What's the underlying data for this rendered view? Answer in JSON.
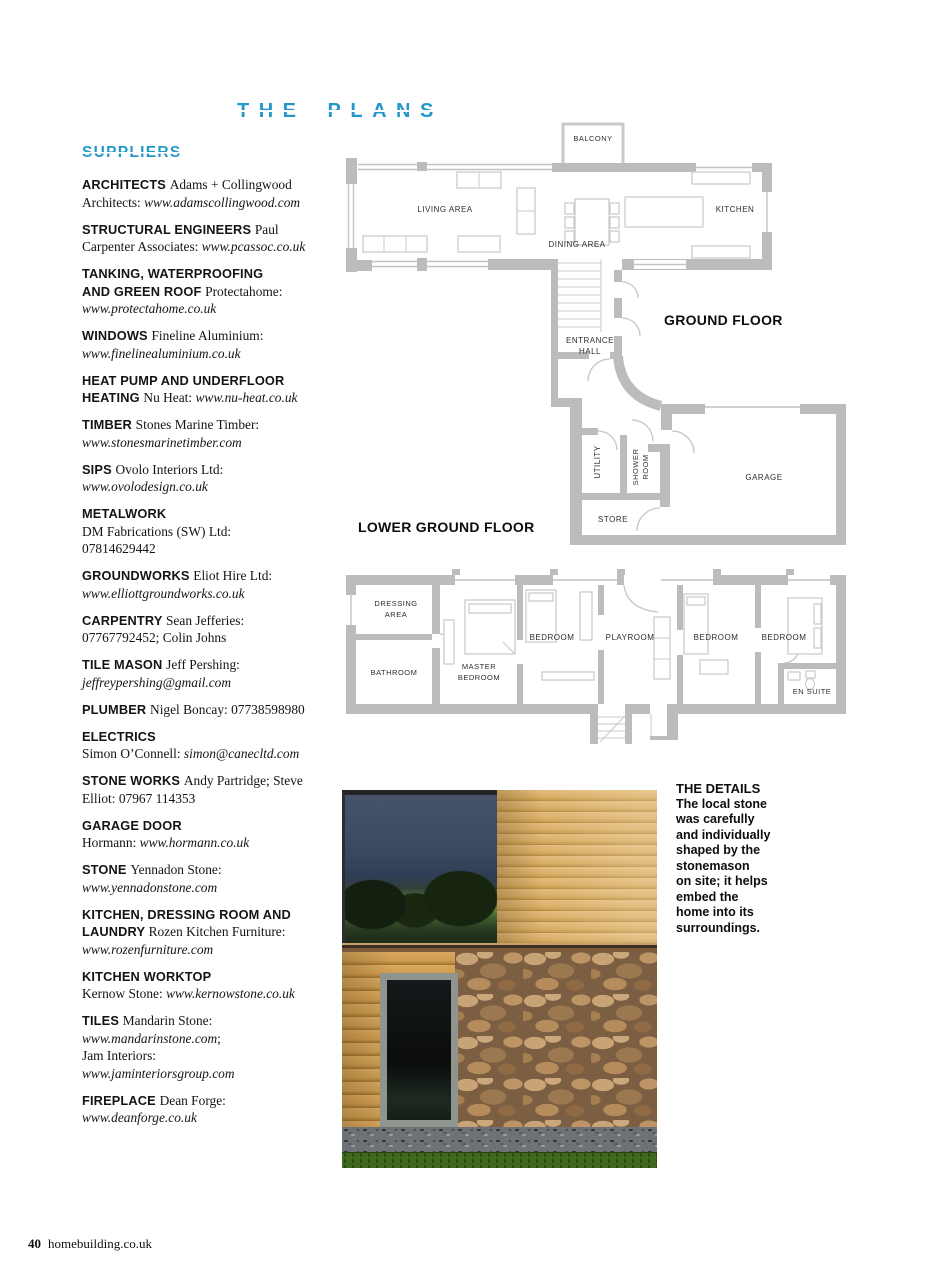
{
  "page": {
    "title": "THE PLANS",
    "footer": {
      "page_number": "40",
      "site": "homebuilding.co.uk"
    }
  },
  "colors": {
    "accent_blue": "#2496c8",
    "plan_wall_gray": "#bcbcbc",
    "plan_label": "#2e2e2e"
  },
  "suppliers": {
    "heading": "SUPPLIERS",
    "entries": [
      {
        "segments": [
          {
            "style": "b",
            "text": "ARCHITECTS "
          },
          {
            "style": "r",
            "text": "Adams + Collingwood Architects: "
          },
          {
            "style": "i",
            "text": "www.adamscollingwood.com"
          }
        ]
      },
      {
        "segments": [
          {
            "style": "b",
            "text": "STRUCTURAL ENGINEERS "
          },
          {
            "style": "r",
            "text": "Paul Carpenter Associates: "
          },
          {
            "style": "i",
            "text": "www.pcassoc.co.uk"
          }
        ]
      },
      {
        "segments": [
          {
            "style": "b",
            "text": "TANKING, WATERPROOFING"
          },
          {
            "style": "br",
            "text": ""
          },
          {
            "style": "b",
            "text": "AND GREEN ROOF "
          },
          {
            "style": "r",
            "text": "Protectahome:"
          },
          {
            "style": "br",
            "text": ""
          },
          {
            "style": "i",
            "text": "www.protectahome.co.uk"
          }
        ]
      },
      {
        "segments": [
          {
            "style": "b",
            "text": "WINDOWS "
          },
          {
            "style": "r",
            "text": "Fineline Aluminium:"
          },
          {
            "style": "br",
            "text": ""
          },
          {
            "style": "i",
            "text": "www.finelinealuminium.co.uk"
          }
        ]
      },
      {
        "segments": [
          {
            "style": "b",
            "text": "HEAT PUMP AND UNDERFLOOR"
          },
          {
            "style": "br",
            "text": ""
          },
          {
            "style": "b",
            "text": "HEATING "
          },
          {
            "style": "r",
            "text": "Nu Heat: "
          },
          {
            "style": "i",
            "text": "www.nu-heat.co.uk"
          }
        ]
      },
      {
        "segments": [
          {
            "style": "b",
            "text": "TIMBER "
          },
          {
            "style": "r",
            "text": "Stones Marine Timber:"
          },
          {
            "style": "br",
            "text": ""
          },
          {
            "style": "i",
            "text": "www.stonesmarinetimber.com"
          }
        ]
      },
      {
        "segments": [
          {
            "style": "b",
            "text": "SIPS "
          },
          {
            "style": "r",
            "text": "Ovolo Interiors Ltd:"
          },
          {
            "style": "br",
            "text": ""
          },
          {
            "style": "i",
            "text": "www.ovolodesign.co.uk"
          }
        ]
      },
      {
        "segments": [
          {
            "style": "b",
            "text": "METALWORK"
          },
          {
            "style": "br",
            "text": ""
          },
          {
            "style": "r",
            "text": "DM Fabrications (SW) Ltd:"
          },
          {
            "style": "br",
            "text": ""
          },
          {
            "style": "r",
            "text": "07814629442"
          }
        ]
      },
      {
        "segments": [
          {
            "style": "b",
            "text": "GROUNDWORKS "
          },
          {
            "style": "r",
            "text": "Eliot Hire Ltd:"
          },
          {
            "style": "br",
            "text": ""
          },
          {
            "style": "i",
            "text": "www.elliottgroundworks.co.uk"
          }
        ]
      },
      {
        "segments": [
          {
            "style": "b",
            "text": "CARPENTRY "
          },
          {
            "style": "r",
            "text": "Sean Jefferies:"
          },
          {
            "style": "br",
            "text": ""
          },
          {
            "style": "r",
            "text": "07767792452; Colin Johns"
          }
        ]
      },
      {
        "segments": [
          {
            "style": "b",
            "text": "TILE MASON "
          },
          {
            "style": "r",
            "text": "Jeff Pershing:"
          },
          {
            "style": "br",
            "text": ""
          },
          {
            "style": "i",
            "text": "jeffreypershing@gmail.com"
          }
        ]
      },
      {
        "segments": [
          {
            "style": "b",
            "text": "PLUMBER "
          },
          {
            "style": "r",
            "text": "Nigel Boncay: 07738598980"
          }
        ]
      },
      {
        "segments": [
          {
            "style": "b",
            "text": "ELECTRICS"
          },
          {
            "style": "br",
            "text": ""
          },
          {
            "style": "r",
            "text": "Simon O’Connell: "
          },
          {
            "style": "i",
            "text": "simon@canecltd.com"
          }
        ]
      },
      {
        "segments": [
          {
            "style": "b",
            "text": "STONE WORKS "
          },
          {
            "style": "r",
            "text": "Andy Partridge; Steve"
          },
          {
            "style": "br",
            "text": ""
          },
          {
            "style": "r",
            "text": "Elliot: 07967 114353"
          }
        ]
      },
      {
        "segments": [
          {
            "style": "b",
            "text": "GARAGE DOOR"
          },
          {
            "style": "br",
            "text": ""
          },
          {
            "style": "r",
            "text": "Hormann: "
          },
          {
            "style": "i",
            "text": "www.hormann.co.uk"
          }
        ]
      },
      {
        "segments": [
          {
            "style": "b",
            "text": "STONE "
          },
          {
            "style": "r",
            "text": "Yennadon Stone:"
          },
          {
            "style": "br",
            "text": ""
          },
          {
            "style": "i",
            "text": "www.yennadonstone.com"
          }
        ]
      },
      {
        "segments": [
          {
            "style": "b",
            "text": "KITCHEN, DRESSING ROOM AND"
          },
          {
            "style": "br",
            "text": ""
          },
          {
            "style": "b",
            "text": "LAUNDRY "
          },
          {
            "style": "r",
            "text": "Rozen Kitchen Furniture:"
          },
          {
            "style": "br",
            "text": ""
          },
          {
            "style": "i",
            "text": "www.rozenfurniture.com"
          }
        ]
      },
      {
        "segments": [
          {
            "style": "b",
            "text": "KITCHEN WORKTOP"
          },
          {
            "style": "br",
            "text": ""
          },
          {
            "style": "r",
            "text": "Kernow Stone: "
          },
          {
            "style": "i",
            "text": "www.kernowstone.co.uk"
          }
        ]
      },
      {
        "segments": [
          {
            "style": "b",
            "text": "TILES "
          },
          {
            "style": "r",
            "text": "Mandarin Stone:"
          },
          {
            "style": "br",
            "text": ""
          },
          {
            "style": "i",
            "text": "www.mandarinstone.com"
          },
          {
            "style": "r",
            "text": ";"
          },
          {
            "style": "br",
            "text": ""
          },
          {
            "style": "r",
            "text": "Jam Interiors:"
          },
          {
            "style": "br",
            "text": ""
          },
          {
            "style": "i",
            "text": "www.jaminteriorsgroup.com"
          }
        ]
      },
      {
        "segments": [
          {
            "style": "b",
            "text": "FIREPLACE "
          },
          {
            "style": "r",
            "text": "Dean Forge:"
          },
          {
            "style": "br",
            "text": ""
          },
          {
            "style": "i",
            "text": "www.deanforge.co.uk"
          }
        ]
      }
    ]
  },
  "plans": {
    "ground": {
      "title": "GROUND FLOOR",
      "balcony": "BALCONY",
      "living": "LIVING AREA",
      "dining": "DINING AREA",
      "kitchen": "KITCHEN",
      "entrance_line1": "ENTRANCE",
      "entrance_line2": "HALL",
      "utility": "UTILITY",
      "shower_line1": "SHOWER",
      "shower_line2": "ROOM",
      "store": "STORE",
      "garage": "GARAGE"
    },
    "lower": {
      "title": "LOWER GROUND FLOOR",
      "dressing_line1": "DRESSING",
      "dressing_line2": "AREA",
      "bathroom": "BATHROOM",
      "master_line1": "MASTER",
      "master_line2": "BEDROOM",
      "bedroom": "BEDROOM",
      "playroom": "PLAYROOM",
      "ensuite": "EN SUITE"
    }
  },
  "details": {
    "heading": "THE DETAILS",
    "body": "The local stone\nwas carefully\nand individually\nshaped by the\nstonemason\non site; it helps\nembed the\nhome into its\nsurroundings."
  }
}
